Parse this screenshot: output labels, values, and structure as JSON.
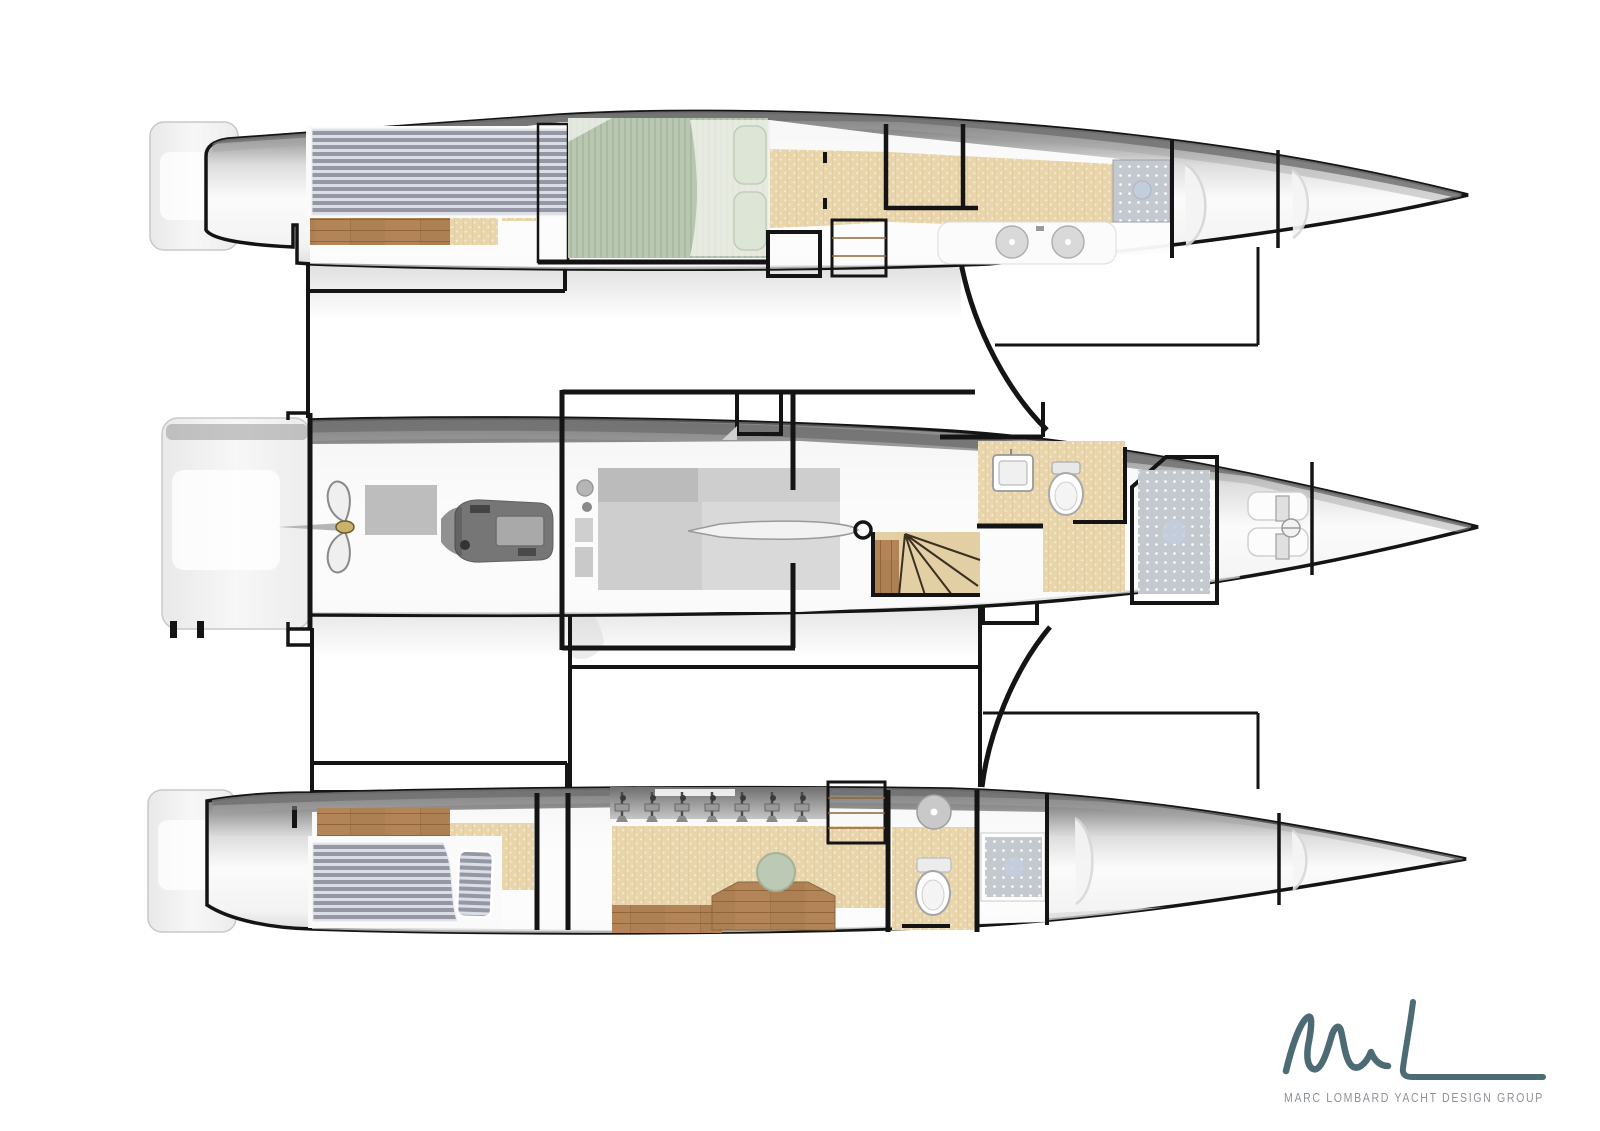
{
  "page": {
    "background": "#ffffff",
    "kind": "yacht-interior-layout-plan"
  },
  "branding": {
    "logo_monogram": "ML",
    "logo_text": "MARC LOMBARD YACHT DESIGN GROUP"
  },
  "drawing": {
    "type": "trimaran-general-arrangement-plan",
    "orientation": "bow-right",
    "hulls": [
      {
        "id": "port-float",
        "position": "top",
        "features": [
          "stern-platform",
          "aft-double-berth",
          "wood-cabin-sole",
          "mid-double-berth-green",
          "door",
          "companionway-steps",
          "corridor-carpet",
          "vanity-twin-sinks",
          "shower",
          "bow-lockers"
        ]
      },
      {
        "id": "main-hull",
        "position": "center",
        "features": [
          "transom-platform",
          "folding-propeller",
          "engine",
          "engine-hatch",
          "saloon-units",
          "daggerboard-trunk",
          "deck-hatch",
          "curved-staircase",
          "head-sink",
          "toilet",
          "shower",
          "forward-berth",
          "windlass",
          "bow-locker"
        ]
      },
      {
        "id": "starboard-float",
        "position": "bottom",
        "features": [
          "stern-platform",
          "aft-double-berth",
          "wardrobe",
          "wet-locker-hanging-gear",
          "desk",
          "desk-seat",
          "companionway-steps",
          "head-sink",
          "toilet",
          "shower",
          "bow-lockers"
        ]
      }
    ]
  },
  "colors": {
    "wall": "#141414",
    "hullTop": "#646464",
    "hullDeck": "#fbfbfb",
    "carpet": "#e8d5ab",
    "carpetDot": "#f5ebce",
    "carpetLine": "#d9c292",
    "wood": "#b28457",
    "woodLine": "#8e6637",
    "woodDark": "#9c7445",
    "bedBase": "#9598a4",
    "bedStripe": "#dcdee6",
    "greenBed": "#b9c7b2",
    "greenStripe": "#a9bba1",
    "greenPillow": "#dde6d6",
    "showerBase": "#c4c9d0",
    "showerDot": "#ffffff",
    "drain": "#c3cedd",
    "seatGreen": "#bcc9b5",
    "logoTeal": "#4d6b74",
    "logoGray": "#8d9298"
  }
}
